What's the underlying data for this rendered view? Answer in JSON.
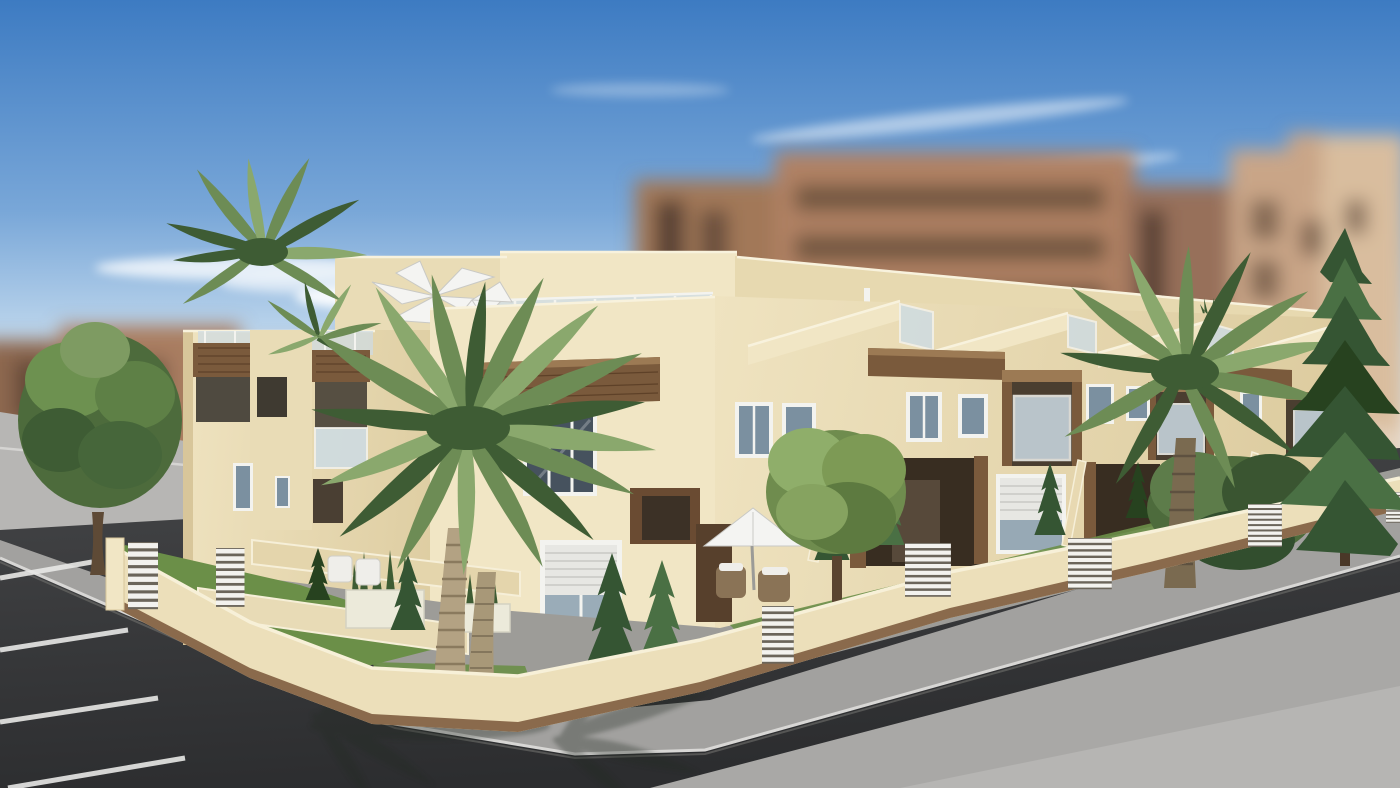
{
  "meta": {
    "type": "3d-architectural-render",
    "description": "Computer-generated real-estate rendering of a new-build corner block of two-storey cream townhouses with wooden balcony accents, roof terraces with glass balustrades and white parasols. Landscaped front gardens with palm trees, cypresses and white planters sit behind a low cream boundary wall with white slatted gates. The block stands on a street corner with grey pavements, a dark asphalt road, marked parking bays on the left, and tall blurred apartment buildings under a blue sky with wispy clouds."
  },
  "scene": {
    "elements": [
      "sky",
      "clouds",
      "blurred background apartment blocks",
      "townhouse block",
      "roof terraces",
      "glass balustrades",
      "white roof parasol",
      "rooftop sofa set",
      "wood fascia bands",
      "wood-and-glass balconies",
      "windows with roller shutters",
      "entrance porches",
      "rooftop pergola",
      "boundary wall",
      "white slatted gates",
      "front gardens",
      "lawns",
      "white planters with sansevieria",
      "garden parasol and wicker chairs",
      "palm trees",
      "deciduous trees",
      "conifer tree",
      "cypress shrubs",
      "pavement",
      "kerb",
      "asphalt road",
      "parking bay lines",
      "palm shadow on pavement"
    ]
  },
  "colors": {
    "sky_top": "#3d7bc2",
    "sky_mid": "#79a7d8",
    "sky_low": "#c6dcef",
    "sky_horizon": "#e8f1f8",
    "cloud": "#ffffff",
    "bg_building": "#a97d60",
    "bg_building_light": "#c9a587",
    "bg_building_dark": "#8d6750",
    "bg_window": "#5a4334",
    "facade_cream_lit": "#f1e6c5",
    "facade_cream": "#e9dcb6",
    "facade_cream_shade": "#d8c69a",
    "wood_accent": "#7a5a3c",
    "wood_accent_light": "#9c7a54",
    "glass_balustrade": "#cddce5",
    "window_glass": "#7b90a0",
    "window_glass_dark": "#46525e",
    "frame_white": "#f3f3ef",
    "roller_shutter": "#e7e7e3",
    "porch_shadow": "#382d21",
    "boundary_wall": "#ecdfba",
    "wall_wood_base": "#8a6a4c",
    "gate_white": "#f3f2ee",
    "lawn_green": "#6b8f48",
    "foliage_green": "#4d6b3c",
    "palm_green": "#6d8c55",
    "conifer_green": "#355533",
    "palm_trunk": "#b3a283",
    "parasol_white": "#f4f4f2",
    "pavement": "#a2a19f",
    "pavement_far": "#a9a8a6",
    "ground_distant": "#b7b6b4",
    "asphalt": "#454648",
    "asphalt_dark": "#2c2d2f",
    "parking_line": "#e8e8e6",
    "kerb_highlight": "#d8d7d5",
    "shadow": "#232a23"
  }
}
